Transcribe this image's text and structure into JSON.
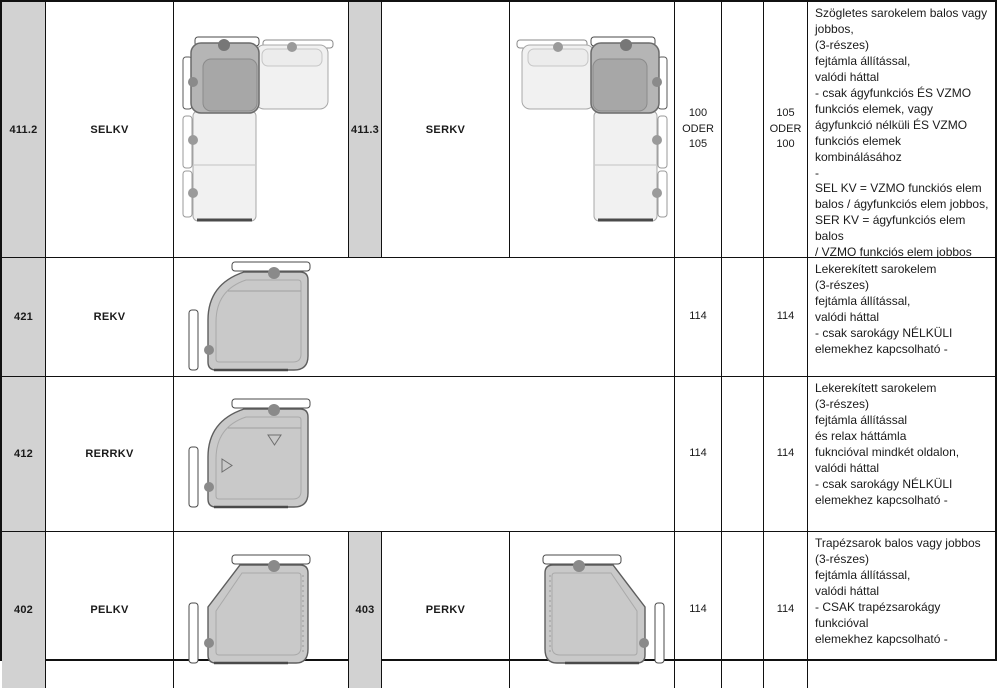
{
  "colors": {
    "header_col_bg": "#d2d2d2",
    "border": "#111111",
    "sofa_dark": "#b5b5b5",
    "sofa_light": "#f1f1f1",
    "sofa_mid": "#c9c9c9"
  },
  "rows": [
    {
      "code1": "411.2",
      "name1": "SELKV",
      "diagram1": "l-shaped-corner-sofa-corner-left",
      "code2": "411.3",
      "name2": "SERKV",
      "diagram2": "l-shaped-corner-sofa-corner-right",
      "dim1": "100\nODER\n105",
      "dim2": "105\nODER\n100",
      "description": "Szögletes sarokelem balos vagy\njobbos,\n(3-részes)\nfejtámla állítással,\nvalódi háttal\n- csak ágyfunkciós ÉS VZMO\nfunkciós elemek, vagy\nágyfunkció nélküli ÉS VZMO\nfunkciós elemek kombinálásához\n-\nSEL KV = VZMO funckiós elem\nbalos / ágyfunkciós elem jobbos,\nSER KV = ágyfunkciós elem balos\n/ VZMO funkciós elem jobbos"
    },
    {
      "code1": "421",
      "name1": "REKV",
      "diagram1": "rounded-corner-element",
      "dim1": "114",
      "dim2": "114",
      "description": "Lekerekített sarokelem\n(3-részes)\nfejtámla állítással,\nvalódi háttal\n- csak sarokágy NÉLKÜLI\nelemekhez kapcsolható -"
    },
    {
      "code1": "412",
      "name1": "RERRKV",
      "diagram1": "rounded-corner-element-relax",
      "dim1": "114",
      "dim2": "114",
      "description": "Lekerekített sarokelem\n(3-részes)\nfejtámla állítással\nés relax háttámla\nfukncióval mindkét oldalon,\nvalódi háttal\n- csak sarokágy NÉLKÜLI\nelemekhez kapcsolható -"
    },
    {
      "code1": "402",
      "name1": "PELKV",
      "diagram1": "trapezoid-corner-element-left",
      "code2": "403",
      "name2": "PERKV",
      "diagram2": "trapezoid-corner-element-right",
      "dim1": "114",
      "dim2": "114",
      "description": "Trapézsarok balos vagy jobbos\n(3-részes)\nfejtámla állítással,\nvalódi háttal\n- CSAK trapézsarokágy funkcióval\nelemekhez kapcsolható -"
    }
  ]
}
